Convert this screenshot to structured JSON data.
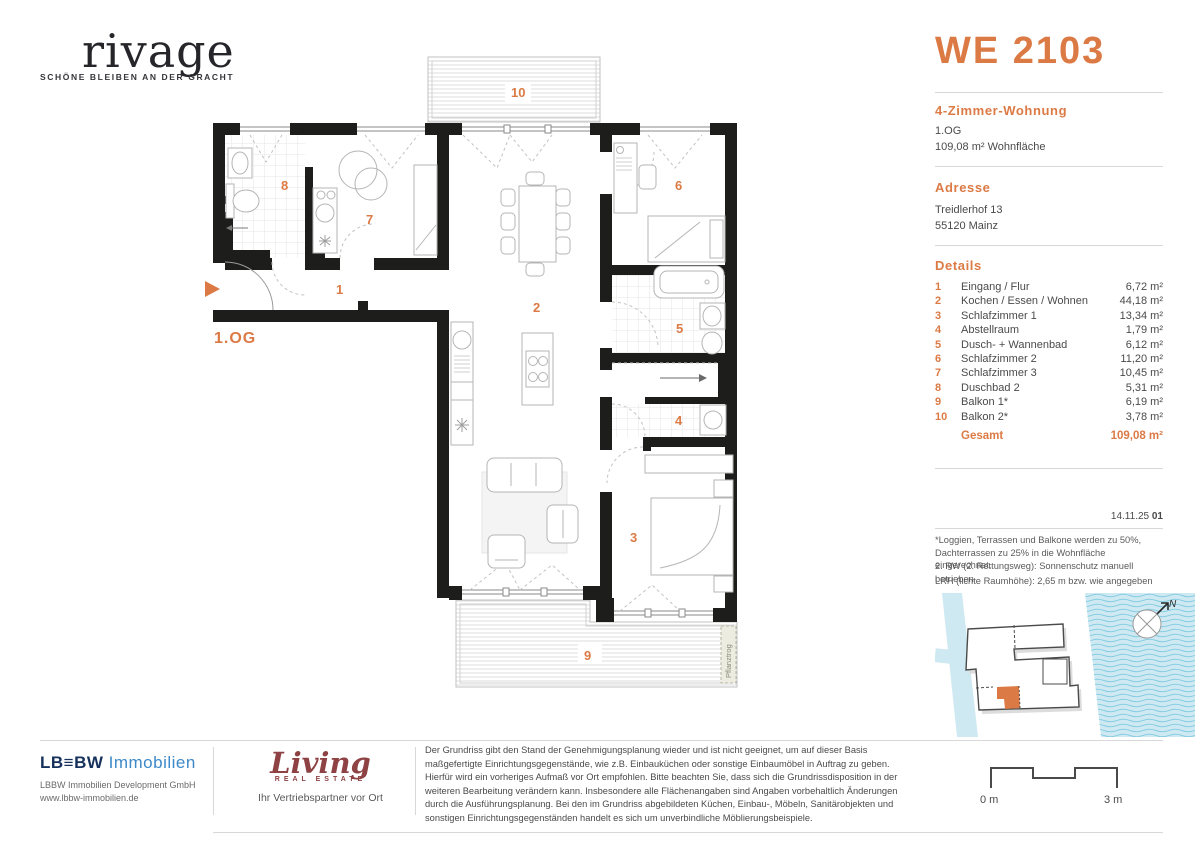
{
  "colors": {
    "accent": "#dc7a45",
    "wall": "#1d1d1b",
    "water": "#cfe9f2",
    "wave": "#86cde2",
    "lbbw_navy": "#16325c",
    "lbbw_blue": "#3d89c9",
    "living_red": "#8e4243"
  },
  "header": {
    "logo_text": "rivage",
    "logo_tagline": "SCHÖNE BLEIBEN AN DER GRACHT",
    "unit_id": "WE 2103"
  },
  "summary": {
    "apartment_type": "4-Zimmer-Wohnung",
    "floor": "1.OG",
    "area": "109,08 m² Wohnfläche"
  },
  "address": {
    "heading": "Adresse",
    "line1": "Treidlerhof 13",
    "line2": "55120 Mainz"
  },
  "details": {
    "heading": "Details",
    "items": [
      {
        "num": "1",
        "name": "Eingang / Flur",
        "area": "6,72 m²"
      },
      {
        "num": "2",
        "name": "Kochen / Essen / Wohnen",
        "area": "44,18 m²"
      },
      {
        "num": "3",
        "name": "Schlafzimmer 1",
        "area": "13,34 m²"
      },
      {
        "num": "4",
        "name": "Abstellraum",
        "area": "1,79 m²"
      },
      {
        "num": "5",
        "name": "Dusch- + Wannenbad",
        "area": "6,12 m²"
      },
      {
        "num": "6",
        "name": "Schlafzimmer 2",
        "area": "11,20 m²"
      },
      {
        "num": "7",
        "name": "Schlafzimmer 3",
        "area": "10,45 m²"
      },
      {
        "num": "8",
        "name": "Duschbad 2",
        "area": "5,31 m²"
      },
      {
        "num": "9",
        "name": "Balkon 1*",
        "area": "6,19 m²"
      },
      {
        "num": "10",
        "name": "Balkon 2*",
        "area": "3,78 m²"
      }
    ],
    "total_label": "Gesamt",
    "total_area": "109,08 m²"
  },
  "revision": {
    "date": "14.11.25",
    "index": "01"
  },
  "footnotes": {
    "fn1": "*Loggien, Terrassen und Balkone werden zu 50%, Dachterrassen zu 25% in die Wohnfläche eingerechnet.",
    "fn2": "2. RW (2. Rettungsweg): Sonnenschutz manuell betrieben",
    "fn3": "LRH (lichte Raumhöhe): 2,65 m bzw. wie angegeben"
  },
  "plan": {
    "floor_label": "1.OG",
    "planter_label": "Pflanztrog",
    "rooms": {
      "r1": "1",
      "r2": "2",
      "r3": "3",
      "r4": "4",
      "r5": "5",
      "r6": "6",
      "r7": "7",
      "r8": "8",
      "r9": "9",
      "r10": "10"
    }
  },
  "sitemap": {
    "north_label": "N"
  },
  "footer": {
    "lbbw_logo_dark": "LB≡BW",
    "lbbw_logo_light": "Immobilien",
    "lbbw_line1": "LBBW Immobilien Development GmbH",
    "lbbw_line2": "www.lbbw-immobilien.de",
    "living_logo": "Living",
    "living_sub": "REAL ESTATE",
    "living_tagline": "Ihr Vertriebspartner vor Ort",
    "disclaimer": "Der Grundriss gibt den Stand der Genehmigungsplanung wieder und ist nicht geeignet, um auf dieser Basis maßgefertigte Einrichtungsgegenstände, wie z.B. Einbauküchen oder sonstige Einbaumöbel in Auftrag zu geben. Hierfür wird ein vorheriges Aufmaß vor Ort empfohlen. Bitte beachten Sie, dass sich die Grundrissdisposition in der weiteren Bearbeitung verändern kann. Insbesondere alle Flächenangaben sind Angaben vorbehaltlich Änderungen durch die Ausführungsplanung. Bei den im Grundriss abgebildeten Küchen, Einbau-, Möbeln, Sanitärobjekten und sonstigen Einrichtungsgegenständen handelt es sich um unverbindliche Möblierungsbeispiele.",
    "scale": {
      "start": "0 m",
      "end": "3 m"
    }
  }
}
